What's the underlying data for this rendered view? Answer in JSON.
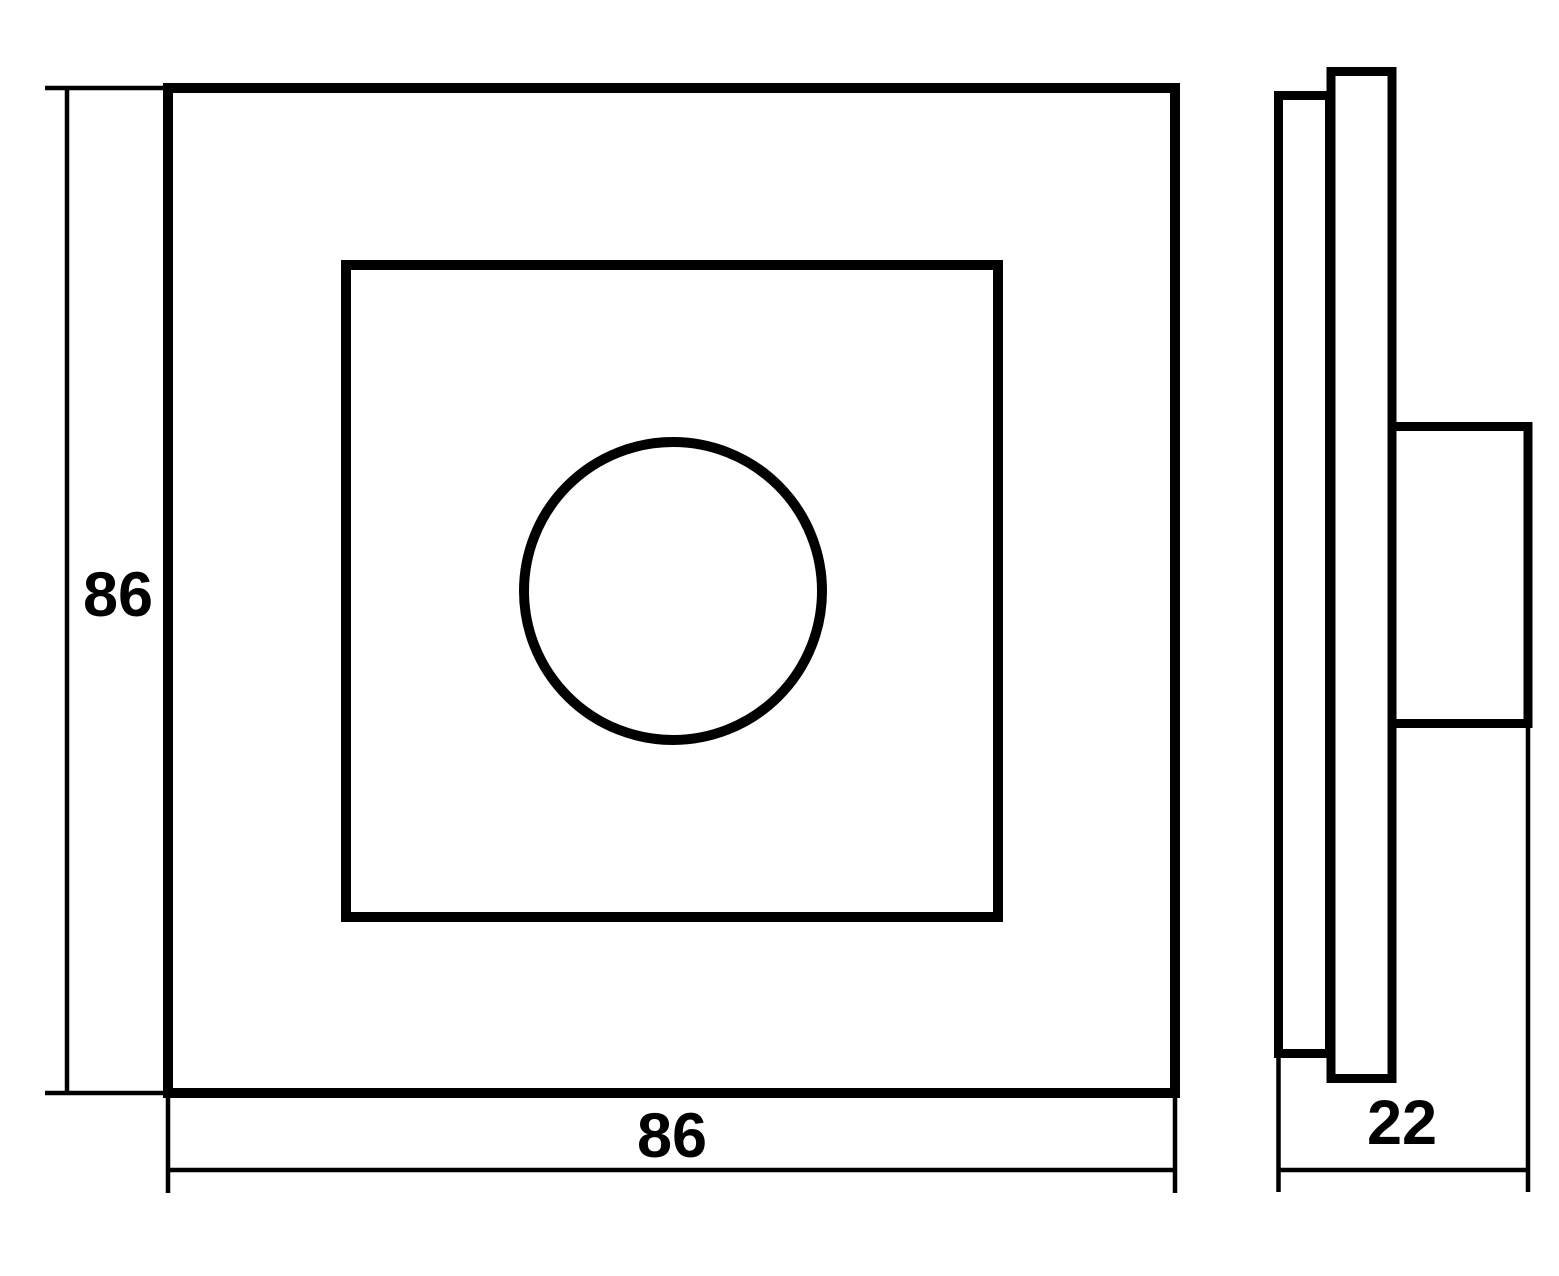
{
  "drawing": {
    "front_view": {
      "height_label": "86",
      "width_label": "86"
    },
    "side_view": {
      "depth_label": "22"
    }
  },
  "colors": {
    "line": "#000000",
    "background": "#ffffff"
  }
}
